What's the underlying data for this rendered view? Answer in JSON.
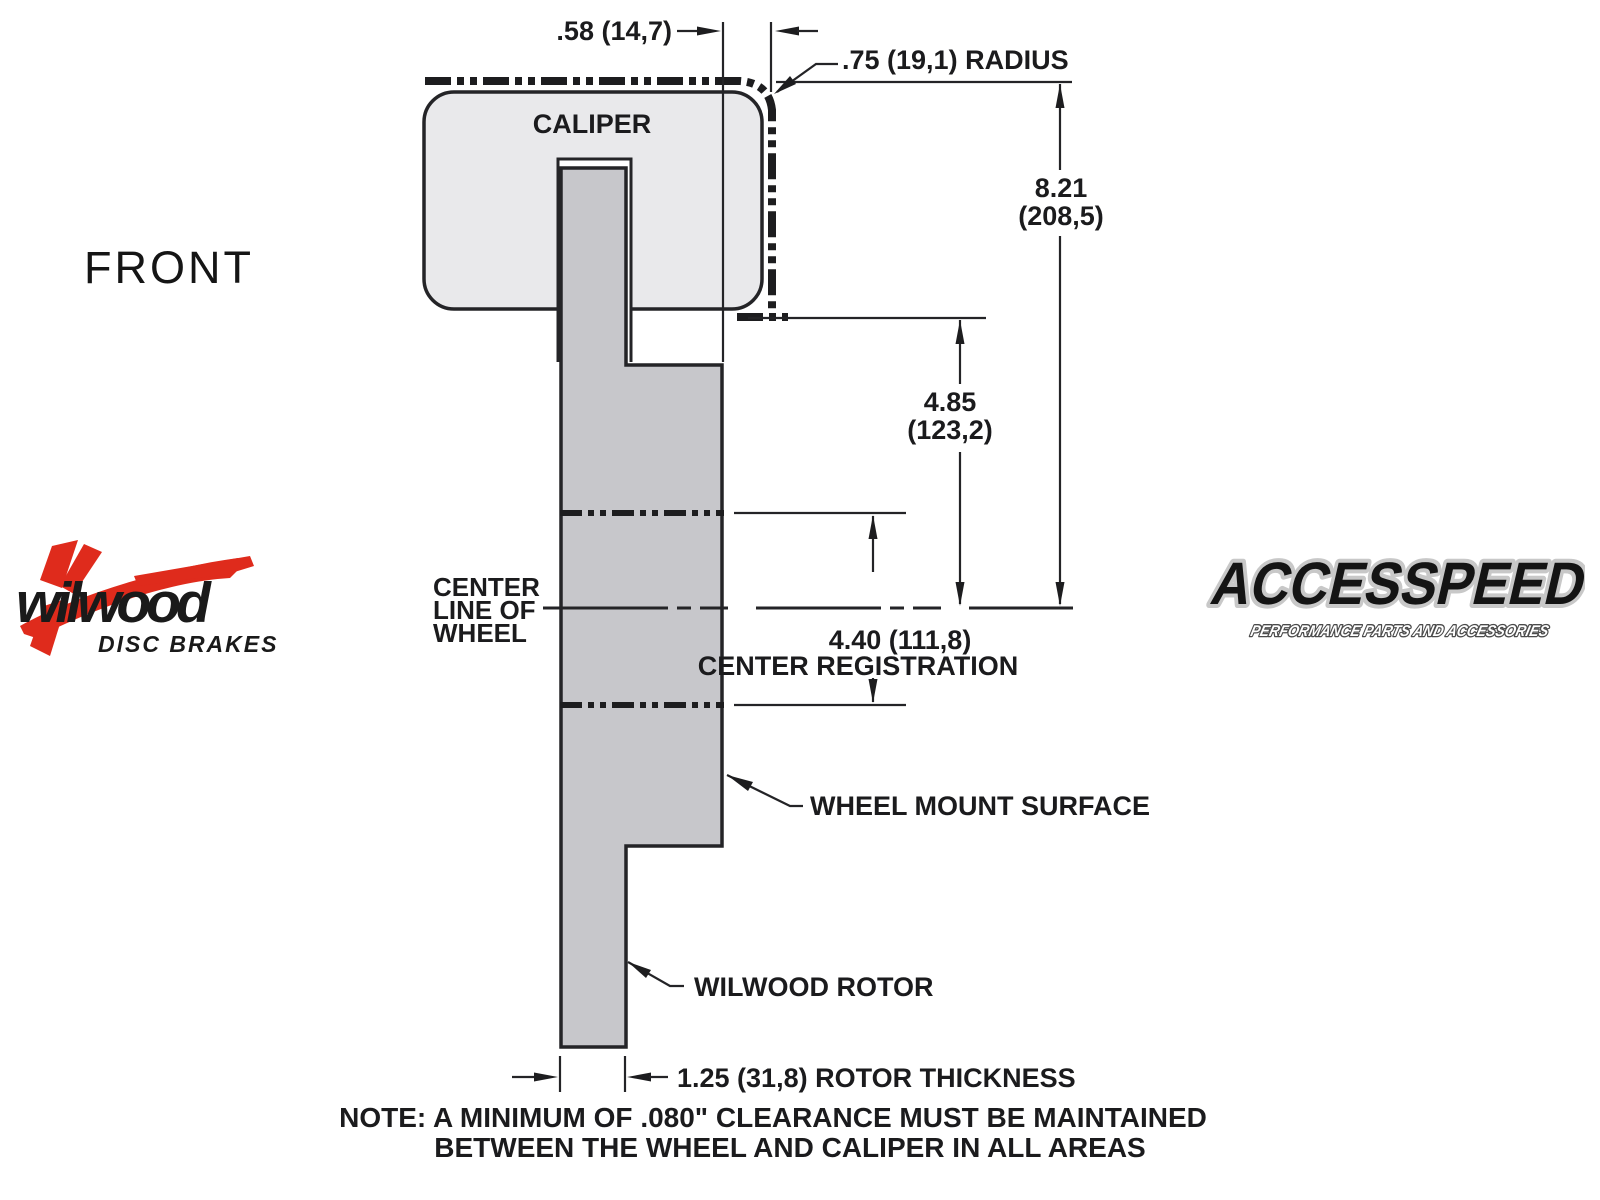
{
  "page": {
    "background": "#ffffff",
    "line_color": "#242427",
    "caliper_fill": "#e9e9eb",
    "rotor_fill": "#c7c7cb",
    "phantom_color": "#1d1d1f"
  },
  "front_label": "FRONT",
  "logos": {
    "wilwood": {
      "name": "wilwood",
      "sub": "DISC BRAKES",
      "red": "#df2b1c",
      "black": "#1a1a1a"
    },
    "accesspeed": {
      "name": "ACCESSPEED",
      "sub": "PERFORMANCE PARTS AND ACCESSORIES",
      "fill": "#141414",
      "outline": "#c8c8c8"
    }
  },
  "diagram": {
    "caliper_label": "CALIPER",
    "dimensions": {
      "wheel_clearance": ".58 (14,7)",
      "radius": ".75 (19,1) RADIUS",
      "overall_height_in": "8.21",
      "overall_height_mm": "(208,5)",
      "mount_depth_in": "4.85",
      "mount_depth_mm": "(123,2)",
      "center_registration_value": "4.40 (111,8)",
      "center_registration_label": "CENTER REGISTRATION",
      "rotor_thickness": "1.25 (31,8) ROTOR THICKNESS"
    },
    "labels": {
      "centerline": [
        "CENTER",
        "LINE OF",
        "WHEEL"
      ],
      "wheel_mount": "WHEEL MOUNT SURFACE",
      "rotor": "WILWOOD ROTOR"
    },
    "note_line1": "NOTE: A MINIMUM OF .080\" CLEARANCE MUST BE MAINTAINED",
    "note_line2": "BETWEEN THE WHEEL AND CALIPER IN ALL AREAS"
  }
}
